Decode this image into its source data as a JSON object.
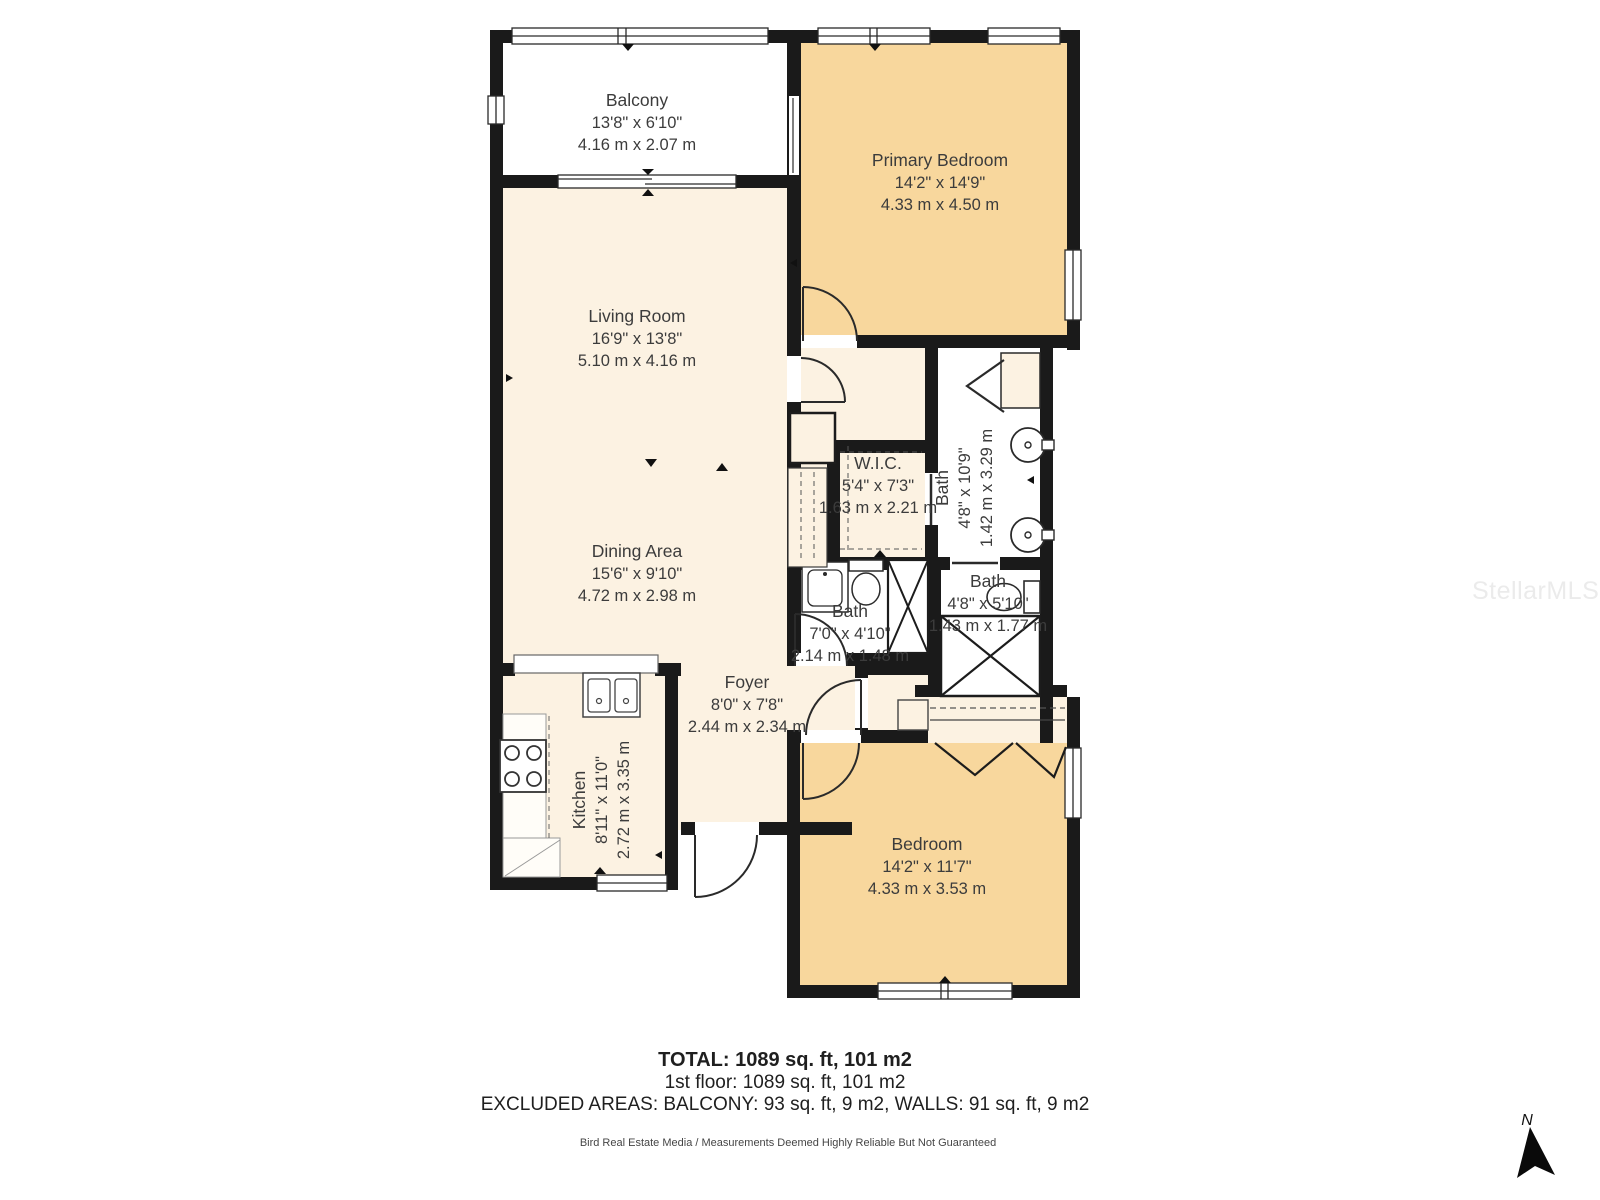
{
  "watermark": "StellarMLS",
  "compass": {
    "label": "N"
  },
  "colors": {
    "wall": "#1a1a1a",
    "floor_cream": "#fcf2e2",
    "floor_warm": "#f8d79d",
    "floor_white": "#ffffff"
  },
  "rooms": {
    "balcony": {
      "name": "Balcony",
      "imperial": "13'8\" x 6'10\"",
      "metric": "4.16 m x 2.07 m"
    },
    "primary_bedroom": {
      "name": "Primary Bedroom",
      "imperial": "14'2\" x 14'9\"",
      "metric": "4.33 m x 4.50 m"
    },
    "living_room": {
      "name": "Living Room",
      "imperial": "16'9\" x 13'8\"",
      "metric": "5.10 m x 4.16 m"
    },
    "dining_area": {
      "name": "Dining Area",
      "imperial": "15'6\" x 9'10\"",
      "metric": "4.72 m x 2.98 m"
    },
    "wic": {
      "name": "W.I.C.",
      "imperial": "5'4\" x 7'3\"",
      "metric": "1.63 m x 2.21 m"
    },
    "bath_primary": {
      "name": "Bath",
      "imperial": "4'8\" x 10'9\"",
      "metric": "1.42 m x 3.29 m"
    },
    "bath_hall": {
      "name": "Bath",
      "imperial": "4'8\" x 5'10\"",
      "metric": "1.43 m x 1.77 m"
    },
    "bath_small": {
      "name": "Bath",
      "imperial": "7'0\" x 4'10\"",
      "metric": "2.14 m x 1.48 m"
    },
    "foyer": {
      "name": "Foyer",
      "imperial": "8'0\" x 7'8\"",
      "metric": "2.44 m x 2.34 m"
    },
    "kitchen": {
      "name": "Kitchen",
      "imperial": "8'11\" x 11'0\"",
      "metric": "2.72 m x 3.35 m"
    },
    "bedroom": {
      "name": "Bedroom",
      "imperial": "14'2\" x 11'7\"",
      "metric": "4.33 m x 3.53 m"
    }
  },
  "summary": {
    "total": "TOTAL: 1089 sq. ft, 101 m2",
    "floor": "1st floor: 1089 sq. ft, 101 m2",
    "excluded": "EXCLUDED AREAS: BALCONY: 93 sq. ft, 9 m2, WALLS: 91 sq. ft, 9 m2",
    "disclaimer": "Bird Real Estate Media / Measurements Deemed Highly Reliable But Not Guaranteed"
  }
}
